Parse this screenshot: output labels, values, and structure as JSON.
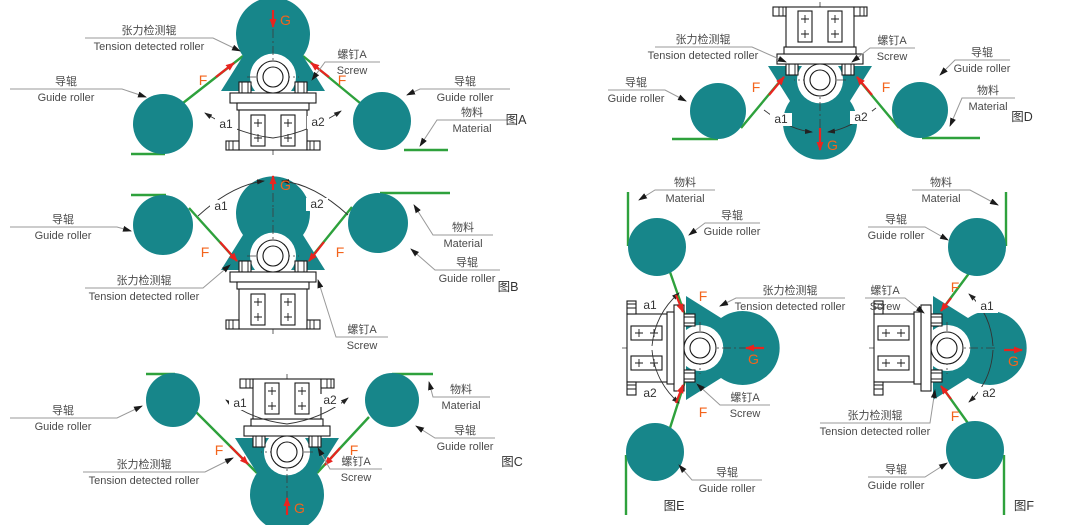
{
  "colors": {
    "teal": "#17868a",
    "green": "#2ea13c",
    "red": "#e8241f",
    "orange": "#f3641c",
    "label": "#4a4a4a",
    "gray": "#999999",
    "dark": "#1a1a1a"
  },
  "labels": {
    "tension_cn": "张力检测辊",
    "tension_en": "Tension detected roller",
    "guide_cn": "导辊",
    "guide_en": "Guide roller",
    "material_cn": "物料",
    "material_en": "Material",
    "screw_cn": "螺钉A",
    "screw_en": "Screw",
    "force": "F",
    "gravity": "G",
    "angle1": "a1",
    "angle2": "a2"
  },
  "figure_titles": {
    "a": "图A",
    "b": "图B",
    "c": "图C",
    "d": "图D",
    "e": "图E",
    "f": "图F"
  }
}
